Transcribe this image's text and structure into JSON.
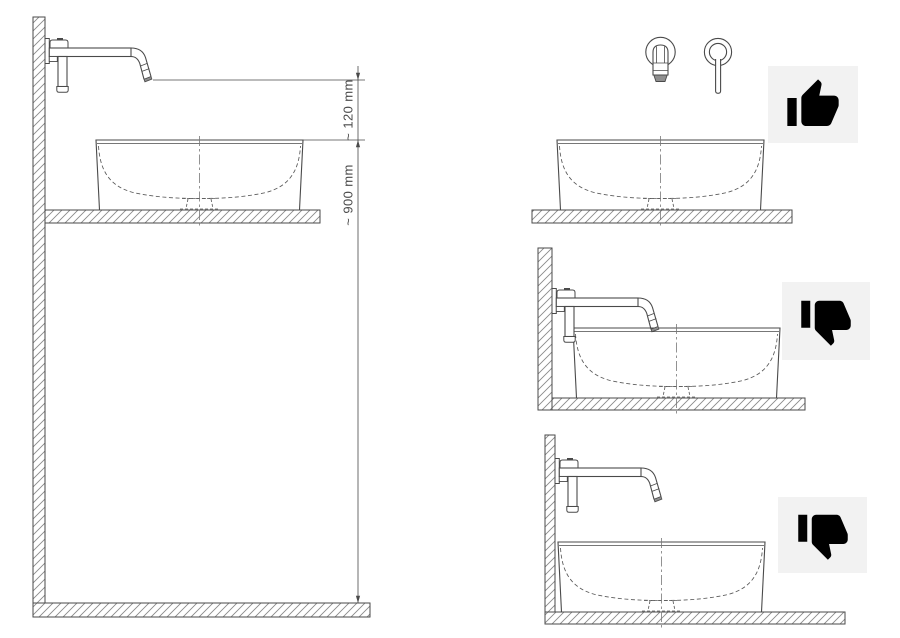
{
  "diagram": {
    "kind": "basin-tap-installation-diagram",
    "dimension_labels": {
      "spout_to_rim": "~ 120 mm",
      "rim_to_floor": "~ 900 mm"
    },
    "scenarios": [
      {
        "position": "left",
        "view": "side",
        "verdict": "",
        "icon": ""
      },
      {
        "position": "top-right",
        "view": "front",
        "verdict": "approved",
        "icon": "thumbs-up"
      },
      {
        "position": "middle-right",
        "view": "side",
        "verdict": "rejected",
        "icon": "thumbs-down"
      },
      {
        "position": "bottom-right",
        "view": "side",
        "verdict": "rejected",
        "icon": "thumbs-down"
      }
    ],
    "colors": {
      "background": "#ffffff",
      "line": "#4a4a4a",
      "hatch": "#8a8a8a",
      "dashed_line": "#5a5a5a",
      "centerline": "#777777",
      "badge_background": "#f2f2f2",
      "icon": "#000000"
    }
  }
}
